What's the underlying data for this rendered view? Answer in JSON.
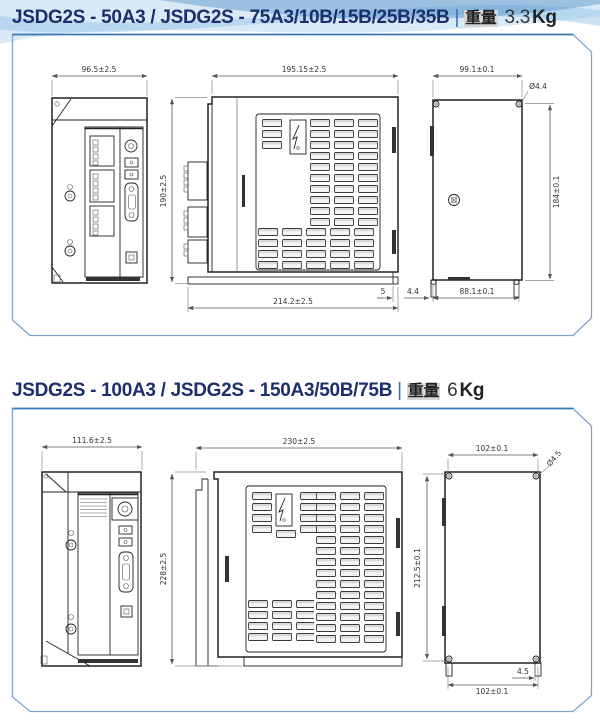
{
  "colors": {
    "title_text": "#1c2f6d",
    "separator": "#2e75b6",
    "panel_border": "#7fa3c8",
    "panel_top_accent": "#3878b4",
    "drawing_line": "#222222",
    "dimension_text": "#333333",
    "wave_light": "#bcd7ee",
    "wave_mid": "#8cc0e6",
    "wave_dark": "#3e84c2"
  },
  "sections": [
    {
      "title": "JSDG2S - 50A3 / JSDG2S - 75A3/10B/15B/25B/35B",
      "separator": "|",
      "weight_label": "重量",
      "weight_value": "3.3",
      "weight_unit": "Kg",
      "dims": {
        "front_width": "96.5±2.5",
        "front_side_height": "190±2.5",
        "side_width": "195.15±2.5",
        "side_bottom_width": "214.2±2.5",
        "side_step": "5",
        "back_foot": "4.4",
        "back_width": "99.1±0.1",
        "back_height": "184±0.1",
        "back_hole_pitch": "88.1±0.1",
        "hole_dia": "Ø4.4"
      }
    },
    {
      "title": "JSDG2S - 100A3 / JSDG2S - 150A3/50B/75B",
      "separator": "|",
      "weight_label": "重量",
      "weight_value": "6",
      "weight_unit": "Kg",
      "dims": {
        "front_width": "111.6±2.5",
        "front_height": "228±2.5",
        "side_width": "230±2.5",
        "back_width": "102±0.1",
        "back_height": "212.5±0.1",
        "back_hole_pitch": "102±0.1",
        "back_foot": "4.5",
        "hole_dia": "Ø4.5"
      }
    }
  ]
}
